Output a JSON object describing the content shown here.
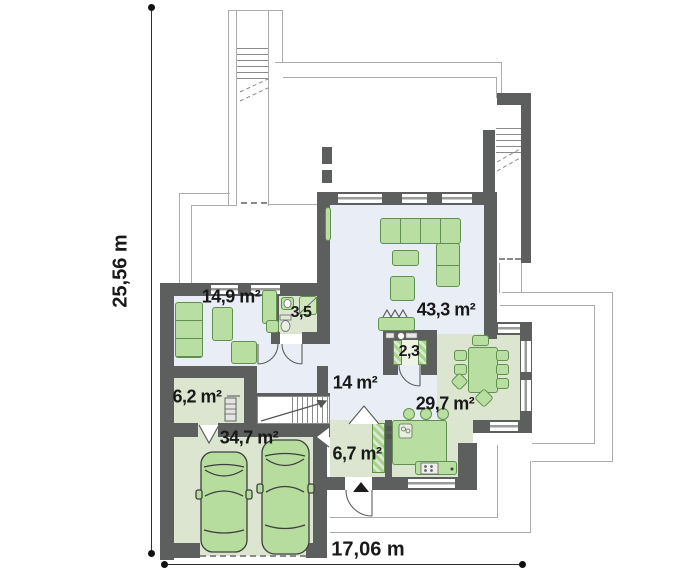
{
  "plan": {
    "dimensions": {
      "vertical": "25,56 m",
      "horizontal": "17,06 m"
    },
    "rooms": {
      "study": "14,9 m²",
      "bathroom": "3,5",
      "living": "43,3 m²",
      "pantry": "2,3",
      "hall": "14 m²",
      "utility": "6,2 m²",
      "dining": "29,7 m²",
      "garage": "34,7 m²",
      "vestibule": "6,7 m²"
    },
    "colors": {
      "wall": "#5d5e5e",
      "floor_day_zone": "#e9eef6",
      "floor_service_zone": "#dbe5d0",
      "furniture": "#b8dea1",
      "furniture_outline": "#61904e",
      "terrace_outline": "#ababab",
      "text": "#191919"
    }
  }
}
